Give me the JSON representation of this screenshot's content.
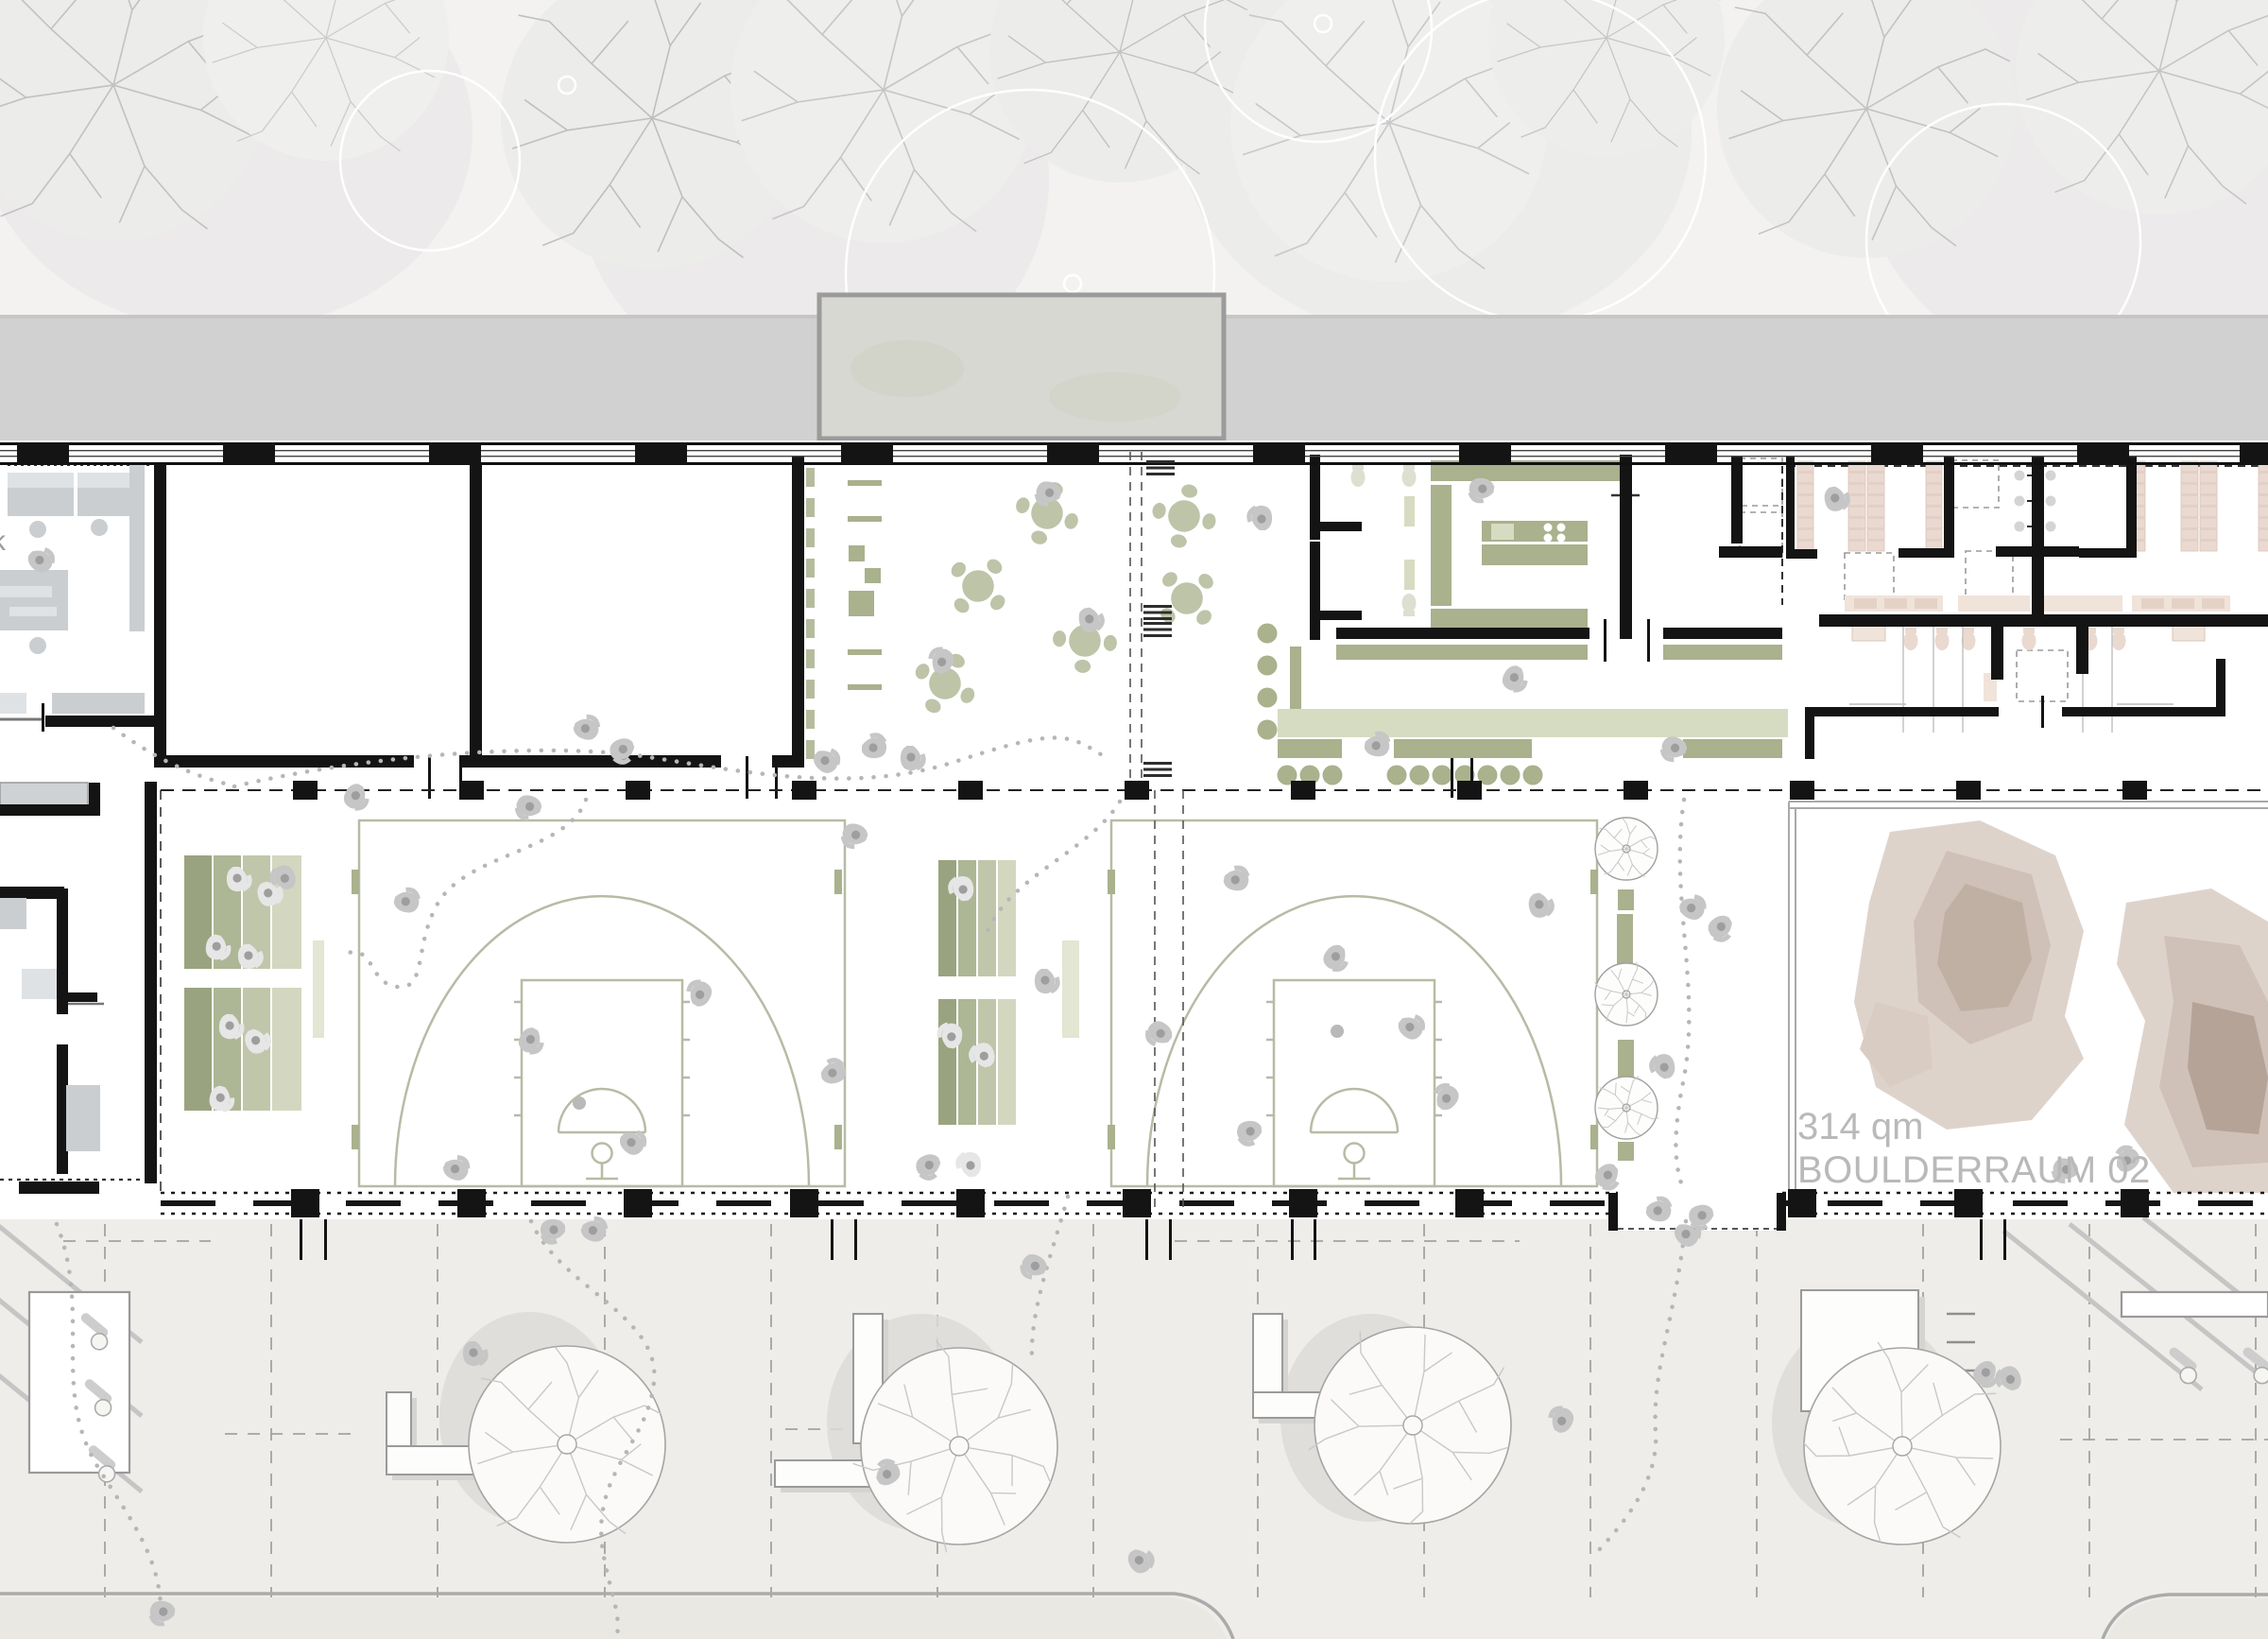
{
  "labels": {
    "area": "314 qm",
    "room": "BOULDERRAUM 02",
    "edge_partial": "k"
  },
  "colors": {
    "ink": "#141414",
    "road": "#d2d1d1",
    "topband": "#f3f2f1",
    "canopy_fill": "#d7d8d2",
    "canopy_stroke": "#9b9b9b",
    "green_dark": "#a9b18d",
    "green_mid": "#bdc4a8",
    "green_light": "#d6dcc2",
    "green_pale": "#e2e6d2",
    "court_line": "#b7bba5",
    "tribune_1": "#9aa37f",
    "tribune_2": "#adb695",
    "tribune_3": "#c0c6aa",
    "tribune_4": "#d3d7c0",
    "locker": "#ead9d0",
    "tan_light": "#f0e3da",
    "boulder_1": "#ded3cb",
    "boulder_2": "#cfc1b7",
    "boulder_3": "#c0b0a4",
    "furniture_gray": "#caced1",
    "plaza": "#efede9",
    "label": "#b9b9b9",
    "people": "#c6c6c6",
    "trail": "#b6b6b6"
  }
}
